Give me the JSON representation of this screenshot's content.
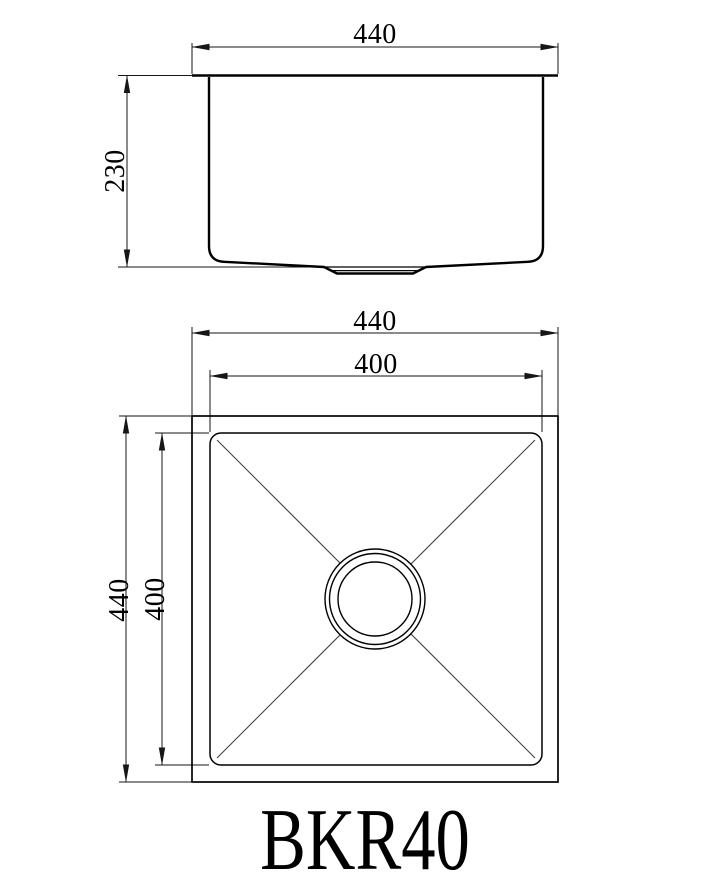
{
  "model_label": "BKR40",
  "front_view": {
    "width_dim": "440",
    "depth_dim": "230"
  },
  "plan_view": {
    "outer_width_dim": "440",
    "inner_width_dim": "400",
    "outer_depth_dim": "440",
    "inner_depth_dim": "400"
  },
  "colors": {
    "object_line": "#000000",
    "dim_line": "#161616",
    "thin_line": "#3f3f3f",
    "background": "#ffffff"
  }
}
